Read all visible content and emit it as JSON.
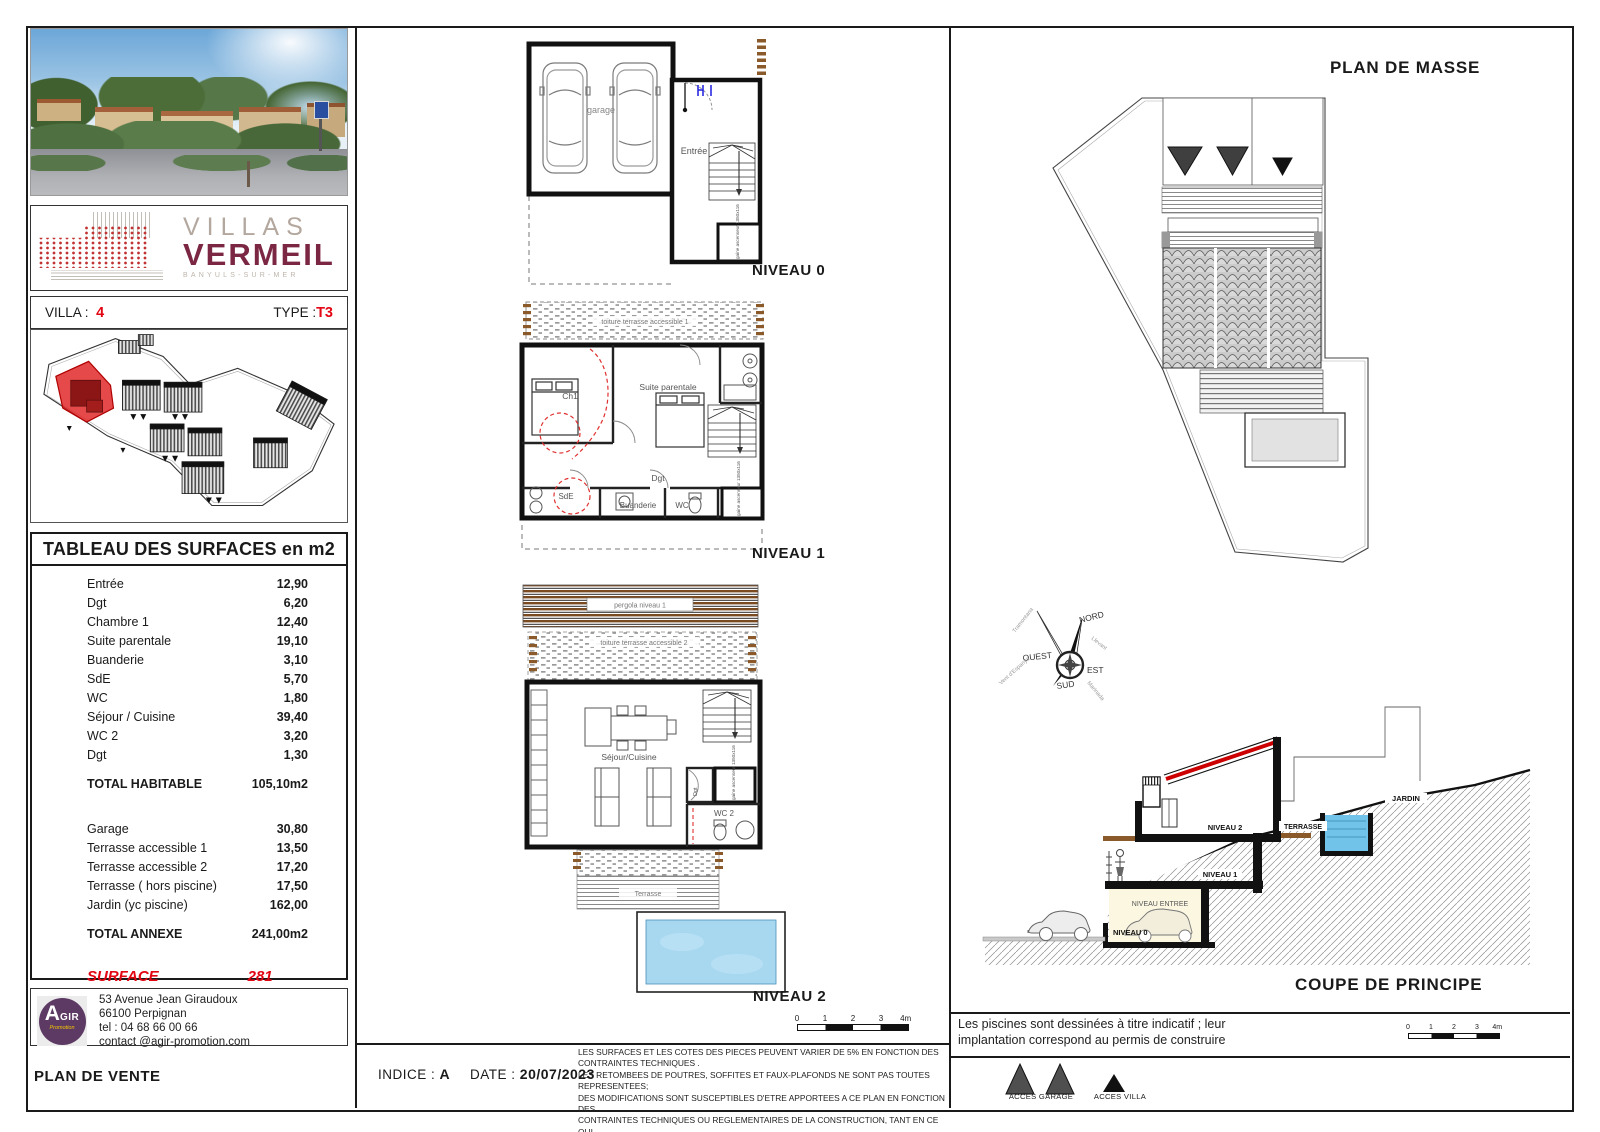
{
  "left": {
    "brand": {
      "line1": "VILLAS",
      "line2": "VERMEIL",
      "subtitle": "BANYULS-SUR-MER"
    },
    "villa_label": "VILLA :",
    "villa_number": "4",
    "type_label": "TYPE :",
    "type_value": "T3",
    "surface_table": {
      "title": "TABLEAU DES SURFACES en m2",
      "rows": [
        {
          "label": "Entrée",
          "value": "12,90"
        },
        {
          "label": "Dgt",
          "value": "6,20"
        },
        {
          "label": "Chambre 1",
          "value": "12,40"
        },
        {
          "label": "Suite parentale",
          "value": "19,10"
        },
        {
          "label": "Buanderie",
          "value": "3,10"
        },
        {
          "label": "SdE",
          "value": "5,70"
        },
        {
          "label": "WC",
          "value": "1,80"
        },
        {
          "label": "Séjour / Cuisine",
          "value": "39,40"
        },
        {
          "label": "WC 2",
          "value": "3,20"
        },
        {
          "label": "Dgt",
          "value": "1,30"
        }
      ],
      "total_habitable": {
        "label": "TOTAL HABITABLE",
        "value": "105,10m2"
      },
      "annex_rows": [
        {
          "label": "Garage",
          "value": "30,80"
        },
        {
          "label": "Terrasse accessible 1",
          "value": "13,50"
        },
        {
          "label": "Terrasse accessible 2",
          "value": "17,20"
        },
        {
          "label": "Terrasse ( hors piscine)",
          "value": "17,50"
        },
        {
          "label": "Jardin (yc piscine)",
          "value": "162,00"
        }
      ],
      "total_annexe": {
        "label": "TOTAL ANNEXE",
        "value": "241,00m2"
      },
      "surface_parcelle": {
        "label": "SURFACE PARCELLE",
        "value": "281 m2"
      }
    },
    "agir": {
      "logo_a": "A",
      "logo_gir": "GIR",
      "logo_promo": "Promotion",
      "address_lines": [
        "53 Avenue Jean Giraudoux",
        "66100 Perpignan",
        "tel : 04 68 66 00 66",
        "contact @agir-promotion.com"
      ]
    },
    "plan_de_vente": "PLAN DE VENTE"
  },
  "plans": {
    "niveau0": {
      "label": "NIVEAU 0",
      "rooms": {
        "garage": "garage",
        "entree": "Entrée",
        "gaine": "gaine ascenseur 1350x116"
      }
    },
    "niveau1": {
      "label": "NIVEAU 1",
      "strip": "toiture terrasse accessible 1",
      "rooms": {
        "ch1": "Ch1",
        "suite": "Suite parentale",
        "dgt": "Dgt",
        "sde": "SdE",
        "buanderie": "Buanderie",
        "wc": "WC",
        "gaine": "gaine ascenseur 1350x116"
      }
    },
    "niveau2": {
      "label": "NIVEAU 2",
      "pergola": "pergola niveau 1",
      "strip": "toiture terrasse accessible 2",
      "rooms": {
        "sejour": "Séjour/Cuisine",
        "dgt": "Dgt",
        "wc2": "WC 2",
        "gaine": "gaine ascenseur 1350x116",
        "terrasse": "Terrasse"
      }
    },
    "scale_ticks": [
      "0",
      "1",
      "2",
      "3",
      "4m"
    ]
  },
  "right": {
    "plan_de_masse_title": "PLAN DE MASSE",
    "compass": {
      "n": "NORD",
      "s": "SUD",
      "e": "EST",
      "w": "OUEST",
      "nw": "Tramontana",
      "ne": "Llevant",
      "sw": "Vent d'Espanya",
      "se": "Marinada"
    },
    "coupe": {
      "title": "COUPE DE PRINCIPE",
      "labels": {
        "niveau0": "NIVEAU 0",
        "niveau_entree": "NIVEAU ENTREE",
        "niveau1": "NIVEAU 1",
        "niveau2": "NIVEAU 2",
        "terrasse": "TERRASSE",
        "jardin": "JARDIN"
      }
    },
    "piscines_note": "Les piscines sont dessinées à titre indicatif ; leur implantation correspond au permis de construire",
    "legend": {
      "acces_garage": "ACCES GARAGE",
      "acces_villa": "ACCES VILLA"
    }
  },
  "footer": {
    "indice_label": "INDICE :",
    "indice_value": "A",
    "date_label": "DATE :",
    "date_value": "20/07/2023",
    "legal_lines": [
      "LES SURFACES ET LES COTES DES PIECES PEUVENT VARIER DE 5% EN FONCTION DES",
      "CONTRAINTES TECHNIQUES .",
      "LES RETOMBEES DE POUTRES, SOFFITES ET FAUX-PLAFONDS NE SONT PAS TOUTES REPRESENTEES;",
      "DES MODIFICATIONS SONT SUSCEPTIBLES D'ETRE APPORTEES A CE PLAN EN FONCTION DES",
      "CONTRAINTES TECHNIQUES OU REGLEMENTAIRES DE LA CONSTRUCTION, TANT EN CE QUI",
      "CONCERNE LES DIMENSIONS LIBRES QUE DE L'EQUIPEMENT"
    ]
  },
  "colors": {
    "brand_maroon": "#7b2743",
    "accent_red": "#e30613",
    "pergola_brown": "#7a4a20",
    "pool_blue": "#a8d8f0",
    "agir_purple": "#5c3a64",
    "agir_yellow": "#f5c400",
    "triangle_gray": "#4f4f4f"
  }
}
